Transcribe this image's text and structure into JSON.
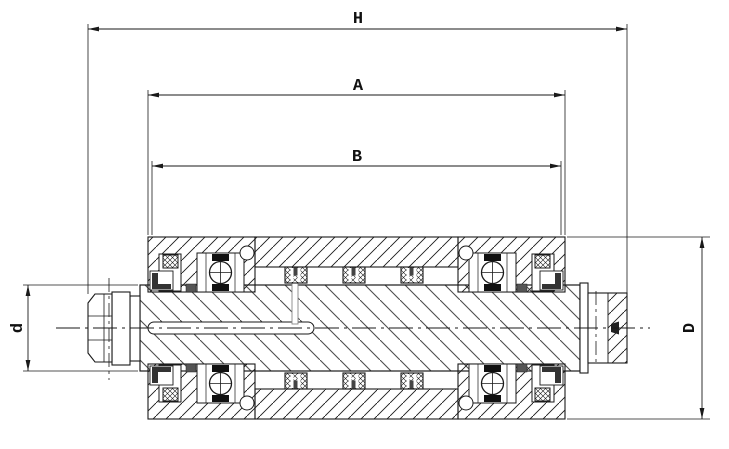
{
  "colors": {
    "background": "#ffffff",
    "line": "#1a1a1a",
    "shaft_hatch": "#4d4d4d",
    "seal_dark": "#333333"
  },
  "drawing": {
    "title": "Bearing roller assembly sectional drawing",
    "dimension_labels": {
      "overall_length": "H",
      "tube_length": "A",
      "bearing_span": "B",
      "shaft_diameter": "d",
      "roller_diameter": "D"
    }
  }
}
